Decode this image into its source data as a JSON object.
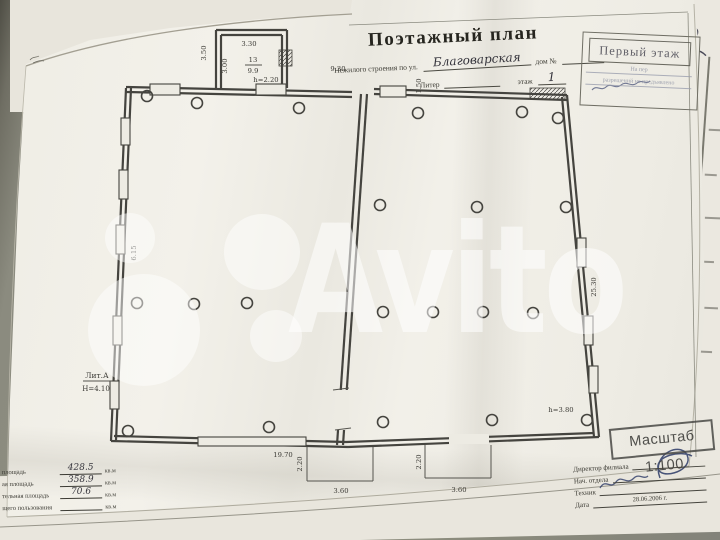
{
  "header": {
    "title": "Поэтажный план",
    "subtitle_prefix": "Нежилого строения по ул.",
    "street_name": "Благоварская",
    "house_label": "дом №",
    "liter_label": "Литер",
    "floor_label": "этаж",
    "floor_value": "1"
  },
  "stamps": {
    "first_floor": "Первый этаж",
    "note_line1": "На пер",
    "note_line3": "разрешений не предъявлено",
    "scale": "Масштаб 1:100"
  },
  "plan": {
    "geometry": {
      "walls": [
        [
          126,
          87,
          352,
          92
        ],
        [
          126,
          92,
          352,
          97
        ],
        [
          126,
          88,
          111,
          441
        ],
        [
          131,
          88,
          116,
          440
        ],
        [
          361,
          94,
          337,
          445
        ],
        [
          367,
          94,
          343,
          445
        ],
        [
          374,
          89,
          567,
          95
        ],
        [
          374,
          94,
          567,
          100
        ],
        [
          567,
          95,
          599,
          437
        ],
        [
          562,
          97,
          594,
          437
        ],
        [
          111,
          441,
          348,
          447
        ],
        [
          114,
          436,
          346,
          442
        ],
        [
          348,
          447,
          599,
          437
        ],
        [
          346,
          442,
          594,
          433
        ],
        [
          216,
          30,
          287,
          30
        ],
        [
          216,
          30,
          216,
          88
        ],
        [
          287,
          30,
          287,
          88
        ],
        [
          221,
          35,
          221,
          88
        ],
        [
          221,
          35,
          282,
          35
        ],
        [
          282,
          35,
          282,
          88
        ]
      ],
      "thin": [
        [
          245,
          65,
          262,
          65
        ],
        [
          83,
          381,
          112,
          381
        ],
        [
          307,
          447,
          307,
          481
        ],
        [
          307,
          481,
          373,
          481
        ],
        [
          373,
          481,
          373,
          447
        ],
        [
          425,
          445,
          425,
          478
        ],
        [
          425,
          478,
          491,
          478
        ],
        [
          491,
          478,
          491,
          445
        ],
        [
          333,
          390,
          349,
          388
        ],
        [
          335,
          430,
          351,
          428
        ]
      ],
      "frames": [
        [
          349,
          25,
          688,
          12
        ],
        [
          688,
          13,
          696,
          457
        ]
      ],
      "windows": [
        [
          121,
          118,
          9,
          27
        ],
        [
          119,
          170,
          9,
          29
        ],
        [
          116,
          225,
          9,
          29
        ],
        [
          113,
          316,
          9,
          29
        ],
        [
          110,
          381,
          9,
          28
        ],
        [
          150,
          84,
          30,
          11
        ],
        [
          256,
          84,
          30,
          11
        ],
        [
          380,
          86,
          26,
          11
        ],
        [
          577,
          238,
          9,
          29
        ],
        [
          584,
          316,
          9,
          29
        ],
        [
          589,
          366,
          9,
          27
        ],
        [
          198,
          437,
          108,
          9
        ]
      ],
      "gaps": [
        [
          335,
          390,
          14,
          40
        ],
        [
          449,
          434,
          40,
          10
        ]
      ],
      "hatches": [
        [
          530,
          88,
          35,
          11
        ],
        [
          279,
          50,
          13,
          16
        ]
      ],
      "columns": [
        [
          147,
          96
        ],
        [
          197,
          103
        ],
        [
          299,
          108
        ],
        [
          137,
          303
        ],
        [
          194,
          304
        ],
        [
          247,
          303
        ],
        [
          128,
          431
        ],
        [
          269,
          427
        ],
        [
          418,
          113
        ],
        [
          522,
          112
        ],
        [
          558,
          118
        ],
        [
          380,
          205
        ],
        [
          477,
          207
        ],
        [
          566,
          207
        ],
        [
          383,
          312
        ],
        [
          433,
          312
        ],
        [
          483,
          312
        ],
        [
          533,
          313
        ],
        [
          383,
          422
        ],
        [
          492,
          420
        ],
        [
          587,
          420
        ]
      ],
      "labels": [
        [
          "3.30",
          249,
          46,
          0
        ],
        [
          "3.50",
          206,
          53,
          -90
        ],
        [
          "3.00",
          227,
          66,
          -90
        ],
        [
          "13",
          253,
          62,
          0
        ],
        [
          "9.9",
          253,
          73,
          0
        ],
        [
          "h=2.20",
          266,
          82,
          0
        ],
        [
          "9.30",
          338,
          71,
          0
        ],
        [
          "1.50",
          421,
          86,
          -90
        ],
        [
          "6.15",
          136,
          253,
          -90
        ],
        [
          "25.30",
          596,
          287,
          -90
        ],
        [
          "Лит.А",
          97,
          378,
          0,
          7.5
        ],
        [
          "Н=4.10",
          96,
          391,
          0,
          7
        ],
        [
          "19.70",
          283,
          457,
          0
        ],
        [
          "2.20",
          302,
          464,
          -90
        ],
        [
          "3.60",
          341,
          493,
          0
        ],
        [
          "2.20",
          421,
          462,
          -90
        ],
        [
          "3.60",
          459,
          492,
          0
        ],
        [
          "h=3.80",
          561,
          412,
          0
        ]
      ]
    }
  },
  "areas_table": {
    "unit": "кв.м",
    "rows": [
      {
        "label": "площадь",
        "value": "428.5"
      },
      {
        "label": "ая площадь",
        "value": "358.9"
      },
      {
        "label": "тельная площадь",
        "value": "70.6"
      },
      {
        "label": "щего пользования",
        "value": ""
      }
    ]
  },
  "signatures": {
    "rows": [
      {
        "label": "Директор филиала",
        "value": ""
      },
      {
        "label": "Нач. отдела",
        "value": ""
      },
      {
        "label": "Техник",
        "value": ""
      },
      {
        "label": "Дата",
        "value": "28.06.2006 г."
      }
    ]
  },
  "watermark": {
    "text": "Avito",
    "color": "#ffffff"
  }
}
